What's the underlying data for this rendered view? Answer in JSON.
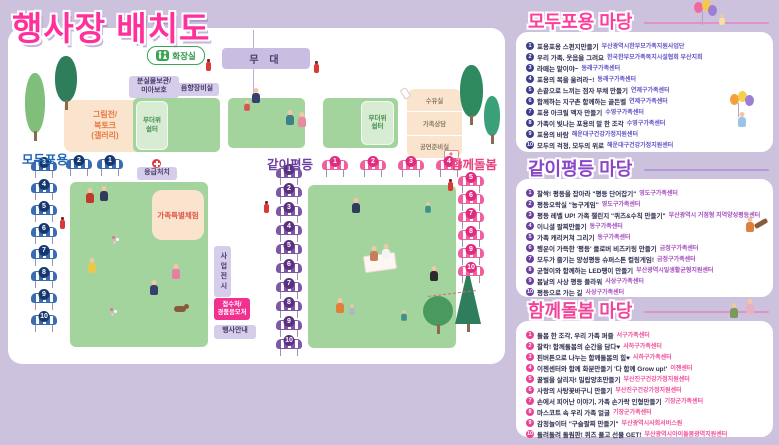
{
  "page": {
    "title": "행사장 배치도"
  },
  "colors": {
    "background": "#cdc2de",
    "title_pink": "#ff2f9b",
    "zone_blue": "#1f66b8",
    "zone_purple": "#6a3fa0",
    "zone_pink": "#e8437f",
    "lawn_green": "#a4d49e",
    "label_purple_bg": "#d6cdea",
    "peach_bg": "#fae4cd",
    "reception_pink": "#f2308f"
  },
  "icons": {
    "restroom": "wc-figures-icon",
    "first_aid": "red-cross-icon",
    "fire_extinguisher": "fire-extinguisher-icon",
    "nursing": "bottle-icon",
    "cart": "first-aid-cart-icon"
  },
  "map": {
    "zones": {
      "inclusion": "모두포용",
      "equality": "같이평등",
      "care": "함께돌봄"
    },
    "labels": {
      "stage": "무 대",
      "restroom": "화장실",
      "lost_found_1": "분실물보관/",
      "lost_found_2": "미아보호",
      "sound_room": "음향장비실",
      "heat_shelter_1": "무더위",
      "heat_shelter_2": "쉼터",
      "art_1": "그림전/",
      "art_2": "북토크",
      "art_3": "(갤러리)",
      "first_aid": "응급처치",
      "family_exp": "가족특별체험",
      "exhibit": "사업전시",
      "reception_1": "접수처/",
      "reception_2": "경품응모처",
      "info": "행사안내",
      "room_nursing": "수유실",
      "room_counsel": "가족상담",
      "room_prep": "공연준비실"
    },
    "booth_groups": [
      {
        "zone": "inclusion",
        "style": "blue",
        "dir": "row",
        "x": 58,
        "y": 131,
        "step": 31,
        "numbers": [
          2,
          1
        ]
      },
      {
        "zone": "inclusion",
        "style": "blue",
        "dir": "col",
        "x": 23,
        "y": 133,
        "step": 22,
        "numbers": [
          3,
          4,
          5,
          6,
          7,
          8,
          9,
          10
        ]
      },
      {
        "zone": "equality",
        "style": "purple",
        "dir": "col",
        "x": 268,
        "y": 140,
        "step": 19,
        "numbers": [
          1,
          2,
          3,
          4,
          5,
          6,
          7,
          8,
          9,
          10
        ]
      },
      {
        "zone": "care",
        "style": "pink",
        "dir": "row",
        "x": 314,
        "y": 132,
        "step": 38,
        "numbers": [
          1,
          2,
          3,
          4
        ]
      },
      {
        "zone": "care",
        "style": "pink",
        "dir": "col",
        "x": 450,
        "y": 148,
        "step": 18,
        "numbers": [
          5,
          6,
          7,
          8,
          9,
          10
        ]
      }
    ]
  },
  "panels": [
    {
      "title": "모두포용 마당",
      "accent": "#ff3c9e",
      "num_color": "#3d3d8f",
      "org_color": "#5f54c4",
      "items": [
        {
          "n": 1,
          "activity": "포용포용 스펀지만들기",
          "org": "부산광역시한부모가족지원사업단"
        },
        {
          "n": 2,
          "activity": "우리 가족, 웃음을 그려요",
          "org": "한국한부모가족복지시설협회 부산지회"
        },
        {
          "n": 3,
          "activity": "라떼는 말이야~",
          "org": "동래구가족센터"
        },
        {
          "n": 4,
          "activity": "포용의 복을 울려라~!",
          "org": "동래구가족센터"
        },
        {
          "n": 5,
          "activity": "손끝으로 느끼는 점자 부채 만들기",
          "org": "연제구가족센터"
        },
        {
          "n": 6,
          "activity": "함께하는 지구촌 함께하는 골든벨",
          "org": "연제구가족센터"
        },
        {
          "n": 7,
          "activity": "포용 아크릴 액자 만들기",
          "org": "수영구가족센터"
        },
        {
          "n": 8,
          "activity": "가족이 빛나는 포용의 말 한 조각",
          "org": "수영구가족센터"
        },
        {
          "n": 9,
          "activity": "포용의 바람",
          "org": "해운대구건강가정지원센터"
        },
        {
          "n": 10,
          "activity": "모두의 걱정, 모두의 위로",
          "org": "해운대구건강가정지원센터"
        }
      ]
    },
    {
      "title": "같이평등 마당",
      "accent": "#8a46c8",
      "num_color": "#6a3fa0",
      "org_color": "#a44fc0",
      "items": [
        {
          "n": 1,
          "activity": "찰싹! 평등을 잡아라 \"평등 단어잡기\"",
          "org": "영도구가족센터"
        },
        {
          "n": 2,
          "activity": "평등오락실 \"농구게임\"",
          "org": "영도구가족센터"
        },
        {
          "n": 3,
          "activity": "평등 레벨 UP! 가족 챌린지 \"퀴즈&수칙 만들기\"",
          "org": "부산광역시 거점형 지역양성평등센터"
        },
        {
          "n": 4,
          "activity": "이니셜 팔찌만들기",
          "org": "동구가족센터"
        },
        {
          "n": 5,
          "activity": "가족 캐리커쳐 그리기",
          "org": "동구가족센터"
        },
        {
          "n": 6,
          "activity": "행운이 가득한 '평등' 클로버 비즈키링 만들기",
          "org": "금정구가족센터"
        },
        {
          "n": 7,
          "activity": "모두가 즐기는 양성평등 슈퍼스톤 컬링게임!",
          "org": "금정구가족센터"
        },
        {
          "n": 8,
          "activity": "균형이와 함께하는 LED팽이 만들기",
          "org": "부산광역시일생활균형지원센터"
        },
        {
          "n": 9,
          "activity": "봄날의 사상 평등 플라워",
          "org": "사상구가족센터"
        },
        {
          "n": 10,
          "activity": "평등으로 가는 길",
          "org": "사상구가족센터"
        }
      ]
    },
    {
      "title": "함께돌봄 마당",
      "accent": "#f0459a",
      "num_color": "#e84393",
      "org_color": "#f0509a",
      "items": [
        {
          "n": 1,
          "activity": "돌봄 한 조각, 우리 가족 퍼즐",
          "org": "서구가족센터"
        },
        {
          "n": 2,
          "activity": "찰칵! 함께돌봄의 순간을 담다♥",
          "org": "사하구가족센터"
        },
        {
          "n": 3,
          "activity": "핀버튼으로 나누는 함께돌봄의 힘♥",
          "org": "사하구가족센터"
        },
        {
          "n": 4,
          "activity": "이젠센터와 함께 화분만들기 '다 함께 Grow up!'",
          "org": "이젠센터"
        },
        {
          "n": 5,
          "activity": "꿀벌을 살리자! 밀랍양초만들기",
          "org": "부산진구건강가정지원센터"
        },
        {
          "n": 6,
          "activity": "사랑의 사탕꽃바구니 만들기",
          "org": "부산진구건강가정지원센터"
        },
        {
          "n": 7,
          "activity": "손에서 피어난 이야기, 가족 손가락 인형만들기",
          "org": "기장군가족센터"
        },
        {
          "n": 8,
          "activity": "마스코트 속 우리 가족 얼굴",
          "org": "기장군가족센터"
        },
        {
          "n": 9,
          "activity": "감정놀이터 \"구슬팔찌 만들기\"",
          "org": "부산광역시사회서비스원"
        },
        {
          "n": 10,
          "activity": "돌려돌려 돌림판! 퀴즈 풀고 선물 GET!",
          "org": "부산광역시아이돌봄광역지원센터"
        }
      ]
    }
  ]
}
